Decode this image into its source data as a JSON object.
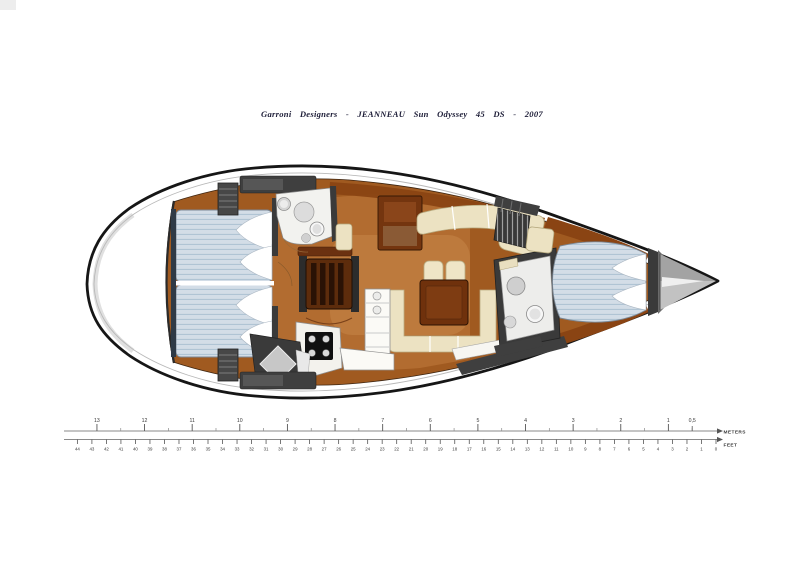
{
  "title": "Garroni Designers  -  JEANNEAU Sun Odyssey 45 DS  -  2007",
  "scale_ruler": {
    "meters_label": "METERS",
    "feet_label": "FEET",
    "meter_tick_labels": [
      "13",
      "12",
      "11",
      "10",
      "9",
      "8",
      "7",
      "6",
      "5",
      "4",
      "3",
      "2",
      "1"
    ],
    "half_meter_tick_label": "0,5",
    "feet_tick_labels": [
      "44",
      "43",
      "42",
      "41",
      "40",
      "39",
      "38",
      "37",
      "36",
      "35",
      "34",
      "33",
      "32",
      "31",
      "30",
      "29",
      "28",
      "27",
      "26",
      "25",
      "24",
      "23",
      "22",
      "21",
      "20",
      "19",
      "18",
      "17",
      "16",
      "15",
      "14",
      "13",
      "12",
      "11",
      "10",
      "9",
      "8",
      "7",
      "6",
      "5",
      "4",
      "3",
      "2",
      "1",
      "0"
    ]
  },
  "colors": {
    "hull_outline": "#161616",
    "floor_dark": "#a05a20",
    "floor_mid": "#b26c30",
    "floor_light": "#c8874a",
    "wood_dark": "#6f310c",
    "wood_trim": "#8a4413",
    "bulkhead": "#3a3a3a",
    "mattress": "#d3dde7",
    "mattress_stripe": "#adc2d2",
    "upholstery": "#ece2c2",
    "fixture_white": "#f2f2ef",
    "ruler_line": "#8a8a8a",
    "ruler_text": "#3a3a3a"
  }
}
